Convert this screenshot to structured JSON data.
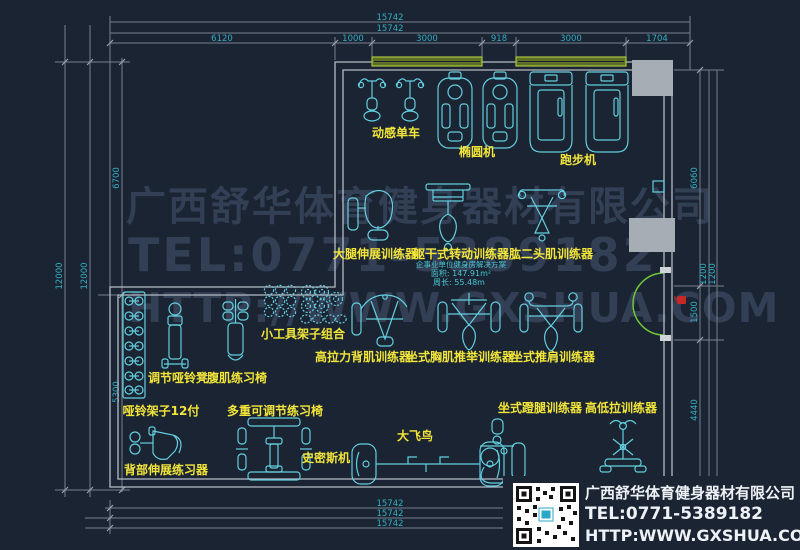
{
  "watermark": {
    "line1": "广西舒华体育健身器材有限公司",
    "line2": "TEL:0771-5389182",
    "line3": "HTTP://WWW.GXSHUA.COM"
  },
  "solution": {
    "title": "企事业单位健身房解决方案",
    "area": "面积: 147.91m²",
    "perimeter": "周长: 55.48m"
  },
  "equipment": [
    {
      "id": "spin-bike",
      "label": "动感单车"
    },
    {
      "id": "elliptical",
      "label": "椭圆机"
    },
    {
      "id": "treadmill",
      "label": "跑步机"
    },
    {
      "id": "leg-extension",
      "label": "大腿伸展训练器"
    },
    {
      "id": "torso-rotation",
      "label": "躯干式转动训练器"
    },
    {
      "id": "biceps-curl",
      "label": "肱二头肌训练器"
    },
    {
      "id": "small-tools-rack",
      "label": "小工具架子组合"
    },
    {
      "id": "lat-pulldown",
      "label": "高拉力背肌训练器"
    },
    {
      "id": "seated-chest-press",
      "label": "坐式胸肌推举训练器"
    },
    {
      "id": "seated-shoulder-press",
      "label": "坐式推肩训练器"
    },
    {
      "id": "adjustable-dumbbell-bench",
      "label": "调节哑铃凳"
    },
    {
      "id": "ab-bench",
      "label": "腹肌练习椅"
    },
    {
      "id": "dumbbell-rack",
      "label": "哑铃架子12付"
    },
    {
      "id": "multi-adjustable-bench",
      "label": "多重可调节练习椅"
    },
    {
      "id": "smith-machine",
      "label": "史密斯机"
    },
    {
      "id": "cable-crossover",
      "label": "大飞鸟"
    },
    {
      "id": "back-extension",
      "label": "背部伸展练习器"
    },
    {
      "id": "seated-leg-press",
      "label": "坐式蹬腿训练器"
    },
    {
      "id": "hi-lo-pulley",
      "label": "高低拉训练器"
    }
  ],
  "dims": {
    "top_total1": "15742",
    "top_total2": "15742",
    "top_segments": [
      "6120",
      "1000",
      "3000",
      "918",
      "3000",
      "1704"
    ],
    "left": [
      "12000",
      "12000",
      "6700",
      "5300"
    ],
    "right": [
      "6060",
      "1200",
      "1200",
      "1500",
      "4440"
    ],
    "bottom": [
      "15742",
      "15742",
      "15742"
    ]
  },
  "footer": {
    "company": "广西舒华体育健身器材有限公司",
    "tel": "TEL:0771-5389182",
    "website": "HTTP:WWW.GXSHUA.COM"
  },
  "colors": {
    "background": "#1a2432",
    "equipment_line": "#64cfe0",
    "label_text": "#f2e53a",
    "dim_text": "#35aec0",
    "wall": "#b4bcc5",
    "window_green": "#a9c441",
    "door_green": "#6fc83a",
    "pillar_gray": "#a7adb4",
    "watermark_gray": "#38445c",
    "marker_red": "#c62828"
  }
}
